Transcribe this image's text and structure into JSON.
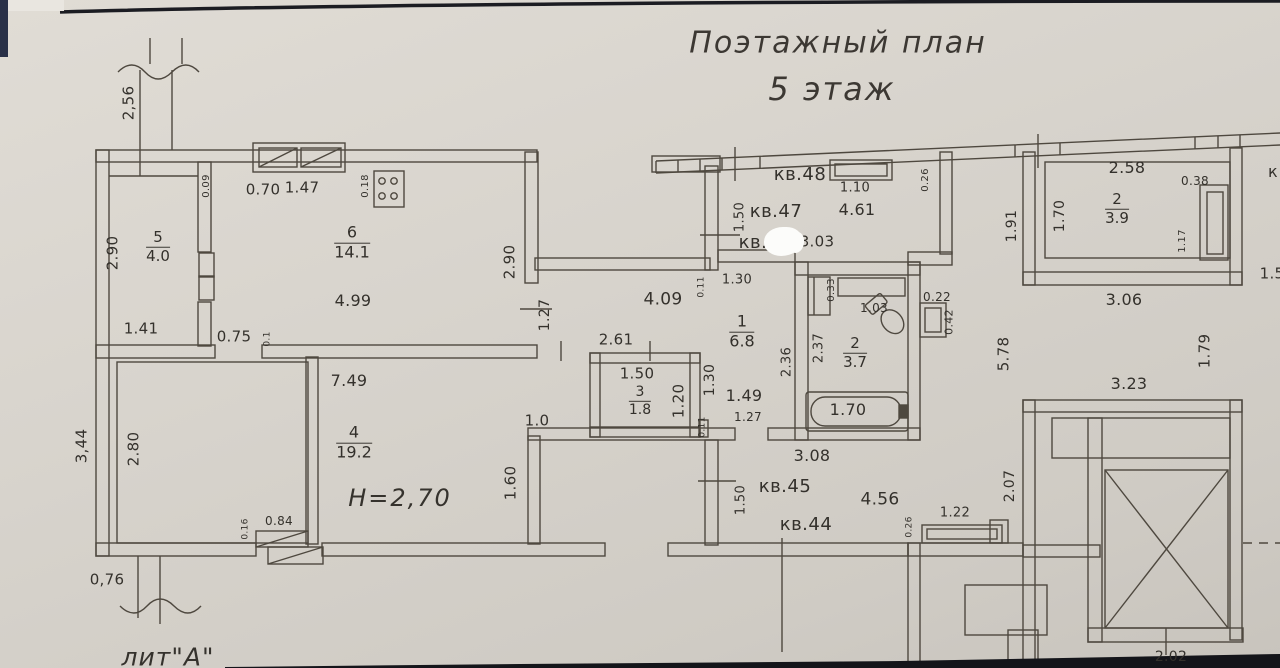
{
  "title": {
    "line1": "Поэтажный план",
    "line2": "5 этаж"
  },
  "notes": {
    "ceiling_height": "H=2,70",
    "litera": "лит\"А\""
  },
  "rooms": [
    {
      "num": "5",
      "area": "4.0",
      "x": 158,
      "y": 247,
      "s": 15
    },
    {
      "num": "6",
      "area": "14.1",
      "x": 352,
      "y": 243,
      "s": 16
    },
    {
      "num": "4",
      "area": "19.2",
      "x": 354,
      "y": 443,
      "s": 16
    },
    {
      "num": "3",
      "area": "1.8",
      "x": 640,
      "y": 401,
      "s": 14
    },
    {
      "num": "1",
      "area": "6.8",
      "x": 742,
      "y": 332,
      "s": 16
    },
    {
      "num": "2",
      "area": "3.7",
      "x": 855,
      "y": 353,
      "s": 15
    },
    {
      "num": "2",
      "area": "3.9",
      "x": 1117,
      "y": 209,
      "s": 15
    }
  ],
  "apartments": [
    {
      "label": "кв.48",
      "x": 800,
      "y": 175
    },
    {
      "label": "кв.47",
      "x": 776,
      "y": 212
    },
    {
      "label": "кв.",
      "x": 753,
      "y": 243
    },
    {
      "label": "кв.45",
      "x": 785,
      "y": 487
    },
    {
      "label": "кв.44",
      "x": 806,
      "y": 525
    }
  ],
  "dims": [
    {
      "t": "2,56",
      "x": 129,
      "y": 103,
      "r": -90,
      "s": 15
    },
    {
      "t": "0.09",
      "x": 207,
      "y": 186,
      "r": -90,
      "s": 10
    },
    {
      "t": "0.70",
      "x": 263,
      "y": 190,
      "s": 15
    },
    {
      "t": "2.90",
      "x": 113,
      "y": 253,
      "r": -90,
      "s": 15
    },
    {
      "t": "1.41",
      "x": 141,
      "y": 329,
      "s": 15
    },
    {
      "t": "0.75",
      "x": 234,
      "y": 337,
      "s": 15
    },
    {
      "t": "0.1",
      "x": 268,
      "y": 339,
      "r": -90,
      "s": 9
    },
    {
      "t": "1.47",
      "x": 302,
      "y": 188,
      "s": 15
    },
    {
      "t": "0.18",
      "x": 366,
      "y": 186,
      "r": -90,
      "s": 10
    },
    {
      "t": "4.99",
      "x": 353,
      "y": 301,
      "s": 16
    },
    {
      "t": "2.90",
      "x": 510,
      "y": 262,
      "r": -90,
      "s": 15
    },
    {
      "t": "1.27",
      "x": 545,
      "y": 315,
      "r": -90,
      "s": 14
    },
    {
      "t": "4.09",
      "x": 663,
      "y": 300,
      "s": 17
    },
    {
      "t": "2.61",
      "x": 616,
      "y": 340,
      "s": 15
    },
    {
      "t": "1.50",
      "x": 637,
      "y": 374,
      "s": 15
    },
    {
      "t": "1.20",
      "x": 679,
      "y": 401,
      "r": -90,
      "s": 15
    },
    {
      "t": "1.30",
      "x": 710,
      "y": 380,
      "r": -90,
      "s": 14
    },
    {
      "t": "0.11",
      "x": 703,
      "y": 427,
      "r": -90,
      "s": 9
    },
    {
      "t": "1.49",
      "x": 744,
      "y": 396,
      "s": 16
    },
    {
      "t": "1.27",
      "x": 748,
      "y": 417,
      "s": 12
    },
    {
      "t": "1.0",
      "x": 537,
      "y": 421,
      "s": 15
    },
    {
      "t": "1.60",
      "x": 511,
      "y": 483,
      "r": -90,
      "s": 15
    },
    {
      "t": "7.49",
      "x": 349,
      "y": 381,
      "s": 16
    },
    {
      "t": "2.80",
      "x": 134,
      "y": 449,
      "r": -90,
      "s": 15
    },
    {
      "t": "3,44",
      "x": 82,
      "y": 446,
      "r": -90,
      "s": 15
    },
    {
      "t": "0.16",
      "x": 246,
      "y": 529,
      "r": -90,
      "s": 9
    },
    {
      "t": "0.84",
      "x": 279,
      "y": 521,
      "s": 12
    },
    {
      "t": "0,76",
      "x": 107,
      "y": 580,
      "s": 15
    },
    {
      "t": "1.10",
      "x": 855,
      "y": 188,
      "s": 13
    },
    {
      "t": "0.26",
      "x": 926,
      "y": 180,
      "r": -90,
      "s": 10
    },
    {
      "t": "4.61",
      "x": 857,
      "y": 210,
      "s": 16
    },
    {
      "t": "1.50",
      "x": 740,
      "y": 217,
      "r": -90,
      "s": 13
    },
    {
      "t": "3.03",
      "x": 817,
      "y": 242,
      "s": 15
    },
    {
      "t": "1.30",
      "x": 737,
      "y": 280,
      "s": 13
    },
    {
      "t": "0.11",
      "x": 702,
      "y": 287,
      "r": -90,
      "s": 9
    },
    {
      "t": "0.33",
      "x": 832,
      "y": 290,
      "r": -90,
      "s": 10
    },
    {
      "t": "1.03",
      "x": 874,
      "y": 308,
      "s": 12
    },
    {
      "t": "2.37",
      "x": 819,
      "y": 348,
      "r": -90,
      "s": 13
    },
    {
      "t": "2.36",
      "x": 787,
      "y": 362,
      "r": -90,
      "s": 13
    },
    {
      "t": "1.70",
      "x": 848,
      "y": 410,
      "s": 16
    },
    {
      "t": "0.22",
      "x": 937,
      "y": 297,
      "s": 12
    },
    {
      "t": "0.42",
      "x": 949,
      "y": 322,
      "r": -90,
      "s": 11
    },
    {
      "t": "3.08",
      "x": 812,
      "y": 456,
      "s": 16
    },
    {
      "t": "4.56",
      "x": 880,
      "y": 500,
      "s": 17
    },
    {
      "t": "1.50",
      "x": 741,
      "y": 500,
      "r": -90,
      "s": 13
    },
    {
      "t": "0.26",
      "x": 910,
      "y": 527,
      "r": -90,
      "s": 9
    },
    {
      "t": "1.22",
      "x": 955,
      "y": 513,
      "s": 13
    },
    {
      "t": "2.58",
      "x": 1127,
      "y": 168,
      "s": 16
    },
    {
      "t": "0.38",
      "x": 1195,
      "y": 181,
      "s": 12
    },
    {
      "t": "1.70",
      "x": 1060,
      "y": 216,
      "r": -90,
      "s": 14
    },
    {
      "t": "1.17",
      "x": 1183,
      "y": 241,
      "r": -90,
      "s": 10
    },
    {
      "t": "1.91",
      "x": 1012,
      "y": 226,
      "r": -90,
      "s": 14
    },
    {
      "t": "3.06",
      "x": 1124,
      "y": 300,
      "s": 16
    },
    {
      "t": "к",
      "x": 1273,
      "y": 172,
      "s": 16
    },
    {
      "t": "1.5",
      "x": 1272,
      "y": 274,
      "s": 15
    },
    {
      "t": "5.78",
      "x": 1004,
      "y": 354,
      "r": -90,
      "s": 15
    },
    {
      "t": "1.79",
      "x": 1205,
      "y": 351,
      "r": -90,
      "s": 15
    },
    {
      "t": "3.23",
      "x": 1129,
      "y": 384,
      "s": 16
    },
    {
      "t": "2.07",
      "x": 1010,
      "y": 486,
      "r": -90,
      "s": 14
    },
    {
      "t": "2.02",
      "x": 1171,
      "y": 657,
      "s": 14
    }
  ]
}
